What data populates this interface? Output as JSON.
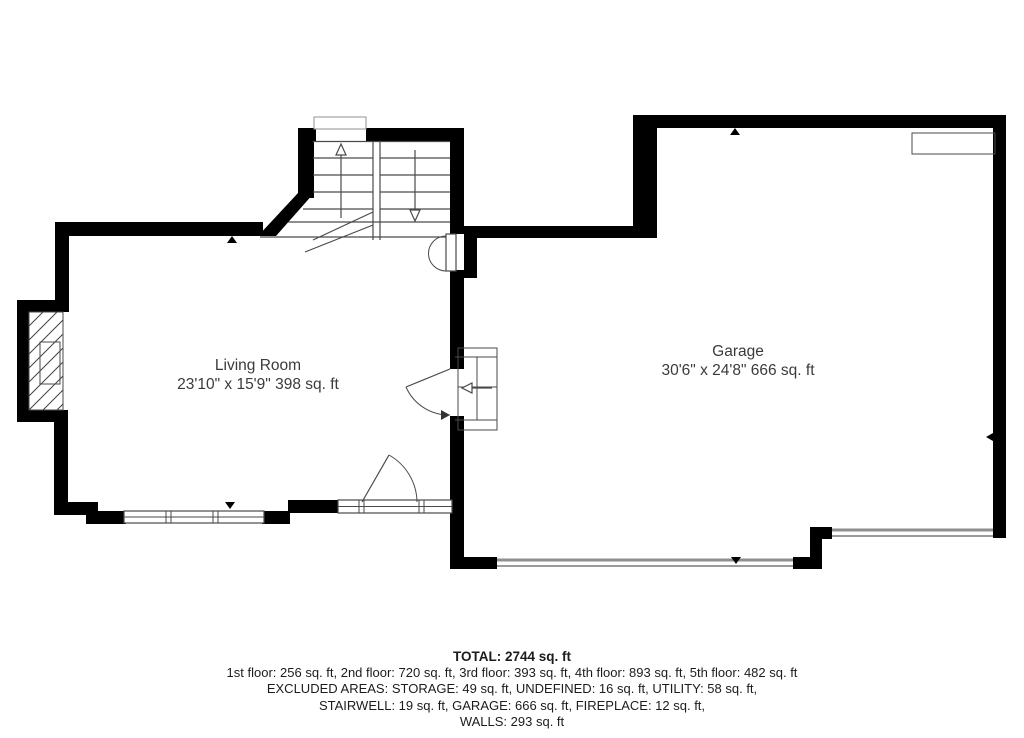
{
  "floor_plan": {
    "rooms": [
      {
        "name": "Living Room",
        "dimensions": "23'10\" x 15'9\" 398 sq. ft"
      },
      {
        "name": "Garage",
        "dimensions": "30'6\" x 24'8\" 666 sq. ft"
      }
    ],
    "summary": {
      "total": "TOTAL: 2744 sq. ft",
      "floors": "1st floor: 256 sq. ft, 2nd floor: 720 sq. ft, 3rd floor: 393 sq. ft, 4th floor: 893 sq. ft, 5th floor: 482 sq. ft",
      "excluded1": "EXCLUDED AREAS: STORAGE: 49 sq. ft, UNDEFINED: 16 sq. ft, UTILITY: 58 sq. ft,",
      "excluded2": "STAIRWELL: 19 sq. ft, GARAGE: 666 sq. ft, FIREPLACE: 12 sq. ft,",
      "walls": "WALLS: 293 sq. ft"
    },
    "icons": {
      "stairs_up_arrow": "arrow-up",
      "stairs_down_arrow": "arrow-down",
      "direction_ticks": "triangle-marker"
    },
    "colors": {
      "wall": "#000000",
      "thin_line": "#4a4a4a",
      "garage_door": "#8f8f8f",
      "room_label": "#3b3b3b",
      "summary_text": "#1c1c1c",
      "background": "#ffffff"
    }
  }
}
